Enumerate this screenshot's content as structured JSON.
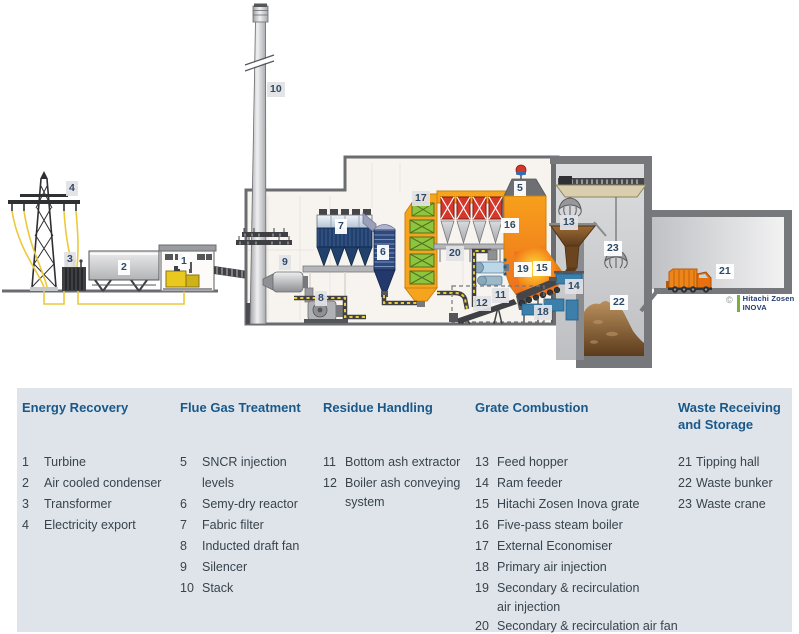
{
  "diagram": {
    "markers": {
      "1": "1",
      "2": "2",
      "3": "3",
      "4": "4",
      "5": "5",
      "6": "6",
      "7": "7",
      "8": "8",
      "9": "9",
      "10": "10",
      "11": "11",
      "12": "12",
      "13": "13",
      "14": "14",
      "15": "15",
      "16": "16",
      "17": "17",
      "18": "18",
      "19": "19",
      "20": "20",
      "21": "21",
      "22": "22",
      "23": "23"
    },
    "logo": {
      "copyright": "©",
      "line1": "Hitachi Zosen",
      "line2": "INOVA"
    }
  },
  "legend": {
    "columns": [
      {
        "title": "Energy Recovery",
        "items": [
          {
            "num": "1",
            "lines": [
              "Turbine"
            ]
          },
          {
            "num": "2",
            "lines": [
              "Air cooled condenser"
            ]
          },
          {
            "num": "3",
            "lines": [
              "Transformer"
            ]
          },
          {
            "num": "4",
            "lines": [
              "Electricity export"
            ]
          }
        ]
      },
      {
        "title": "Flue Gas Treatment",
        "items": [
          {
            "num": "5",
            "lines": [
              "SNCR injection levels"
            ]
          },
          {
            "num": "6",
            "lines": [
              "Semy-dry reactor"
            ]
          },
          {
            "num": "7",
            "lines": [
              "Fabric filter"
            ]
          },
          {
            "num": "8",
            "lines": [
              "Inducted draft fan"
            ]
          },
          {
            "num": "9",
            "lines": [
              "Silencer"
            ]
          },
          {
            "num": "10",
            "lines": [
              "Stack"
            ]
          }
        ]
      },
      {
        "title": "Residue Handling",
        "items": [
          {
            "num": "11",
            "lines": [
              "Bottom ash extractor"
            ]
          },
          {
            "num": "12",
            "lines": [
              "Boiler ash conveying",
              "system"
            ]
          }
        ]
      },
      {
        "title": "Grate Combustion",
        "items": [
          {
            "num": "13",
            "lines": [
              "Feed hopper"
            ]
          },
          {
            "num": "14",
            "lines": [
              "Ram feeder"
            ]
          },
          {
            "num": "15",
            "lines": [
              "Hitachi Zosen Inova grate"
            ]
          },
          {
            "num": "16",
            "lines": [
              "Five-pass steam boiler"
            ]
          },
          {
            "num": "17",
            "lines": [
              "External Economiser"
            ]
          },
          {
            "num": "18",
            "lines": [
              "Primary air injection"
            ]
          },
          {
            "num": "19",
            "lines": [
              "Secondary & recirculation",
              "air injection"
            ]
          },
          {
            "num": "20",
            "lines": [
              "Secondary & recirculation air fan"
            ]
          }
        ]
      },
      {
        "title": "Waste Receiving and Storage",
        "items": [
          {
            "num": "21",
            "lines": [
              "Tipping hall"
            ]
          },
          {
            "num": "22",
            "lines": [
              "Waste bunker"
            ]
          },
          {
            "num": "23",
            "lines": [
              "Waste crane"
            ]
          }
        ]
      }
    ]
  },
  "colors": {
    "accent_orange": "#f6a41d",
    "accent_red": "#d5372b",
    "accent_green": "#8cc63e",
    "accent_blue": "#3fa9d8",
    "filter_navy": "#21406b",
    "legend_bg": "#dee4ea",
    "header_blue": "#19588a",
    "text": "#39434d",
    "cable_yellow": "#ecc93a",
    "building_fill": "#f7f4ef",
    "outline_gray": "#6b6c70"
  }
}
